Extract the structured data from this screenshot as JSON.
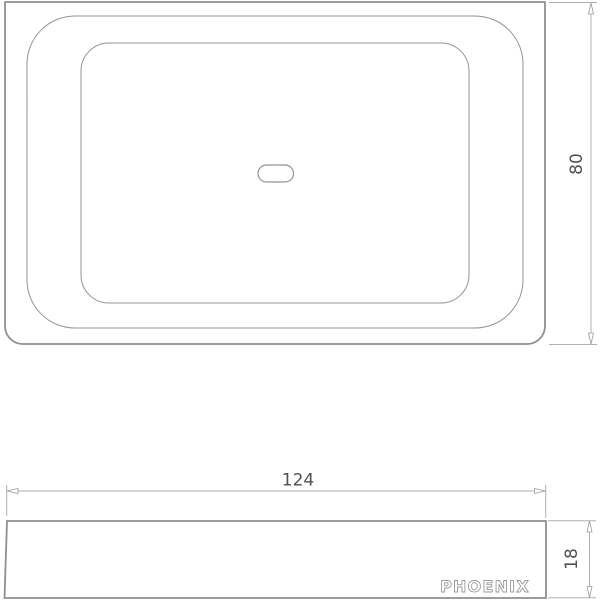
{
  "drawing": {
    "brand": "PHOENIX",
    "dimensions": {
      "width_label": "124",
      "height_label": "80",
      "depth_label": "18"
    },
    "colors": {
      "object_line": "#8f8f8f",
      "detail_line": "#939393",
      "dim_line": "#b0b0b0",
      "arrow_fill": "#ffffff",
      "arrow_stroke": "#9a9a9a",
      "text": "#4f4f4f",
      "brand_outline": "#9a9a9a",
      "background": "#ffffff"
    }
  }
}
